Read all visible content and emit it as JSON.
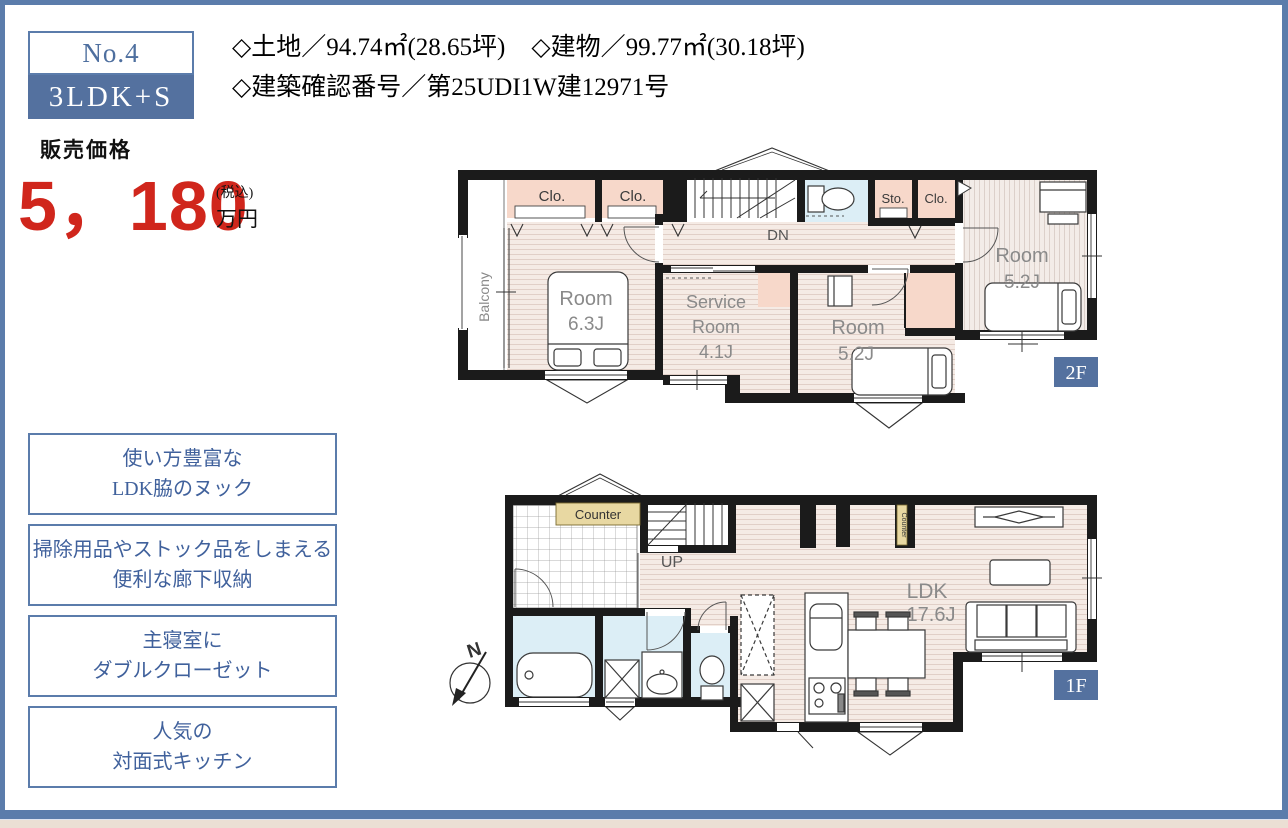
{
  "page": {
    "frame_color": "#5b7cab",
    "background": "#ffffff",
    "bottom_strip_color": "#ebdfd4"
  },
  "unit_badge": {
    "number": "No.4",
    "layout": "3LDK+S"
  },
  "property_info": {
    "land": "◇土地／94.74㎡(28.65坪)",
    "building": "◇建物／99.77㎡(30.18坪)",
    "confirmation": "◇建築確認番号／第25UDI1W建12971号"
  },
  "price": {
    "label": "販売価格",
    "amount": "5，180",
    "tax_note": "(税込)",
    "unit": "万円",
    "color": "#d0261c"
  },
  "features": [
    {
      "line1": "使い方豊富な",
      "line2": "LDK脇のヌック"
    },
    {
      "line1": "掃除用品やストック品をしまえる",
      "line2": "便利な廊下収納"
    },
    {
      "line1": "主寝室に",
      "line2": "ダブルクローゼット"
    },
    {
      "line1": "人気の",
      "line2": "対面式キッチン"
    }
  ],
  "plan_2f": {
    "badge": "2F",
    "balcony": "Balcony",
    "room1_name": "Room",
    "room1_size": "6.3J",
    "service_line1": "Service",
    "service_line2": "Room",
    "service_line3": "4.1J",
    "room2_name": "Room",
    "room2_size": "5.2J",
    "room3_name": "Room",
    "room3_size": "5.2J",
    "closet1": "Clo.",
    "closet2": "Clo.",
    "storage": "Sto.",
    "closet3": "Clo.",
    "stairs": "DN"
  },
  "plan_1f": {
    "badge": "1F",
    "counter_top": "Counter",
    "counter_side": "Counter",
    "stairs": "UP",
    "ldk_name": "LDK",
    "ldk_size": "17.6J",
    "compass": "N"
  },
  "colors": {
    "closet_pink": "#f7d8ca",
    "wet_area_blue": "#dceef6",
    "counter_tan": "#e8d8a2",
    "wall_black": "#1b1b1b",
    "badge_blue": "#54719f"
  }
}
